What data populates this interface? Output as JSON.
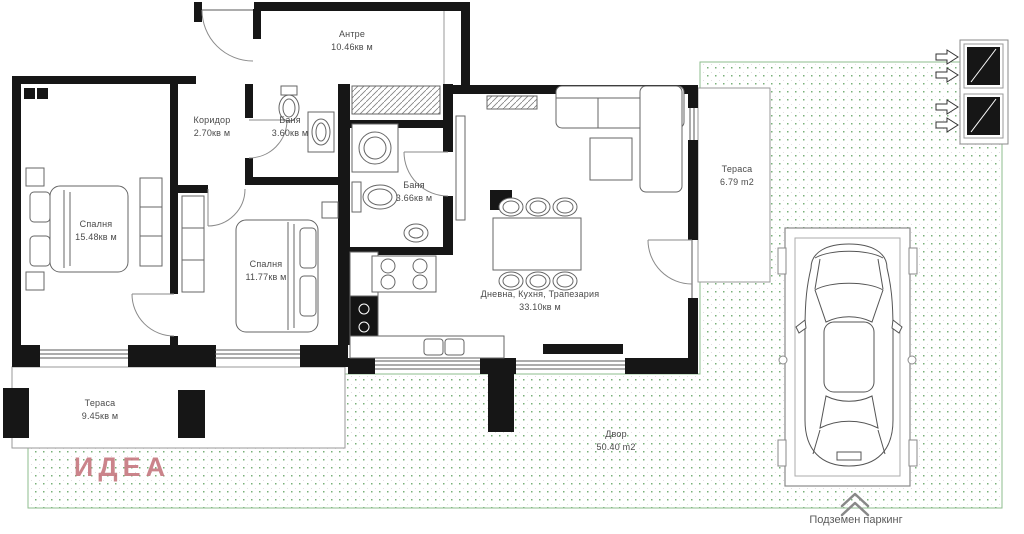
{
  "plan": {
    "logo": "ИДЕА",
    "rooms": [
      {
        "id": "entry",
        "name": "Антре",
        "area": "10.46кв м"
      },
      {
        "id": "bedroom-1",
        "name": "Спалня",
        "area": "15.48кв м"
      },
      {
        "id": "corridor",
        "name": "Коридор",
        "area": "2.70кв м"
      },
      {
        "id": "bathroom-1",
        "name": "Баня",
        "area": "3.60кв м"
      },
      {
        "id": "bathroom-2",
        "name": "Баня",
        "area": "3.66кв м"
      },
      {
        "id": "bedroom-2",
        "name": "Спалня",
        "area": "11.77кв м"
      },
      {
        "id": "living",
        "name": "Дневна, Кухня, Трапезария",
        "area": "33.10кв м"
      },
      {
        "id": "terrace-right",
        "name": "Тераса",
        "area": "6.79 m2"
      },
      {
        "id": "terrace-bottom",
        "name": "Тераса",
        "area": "9.45кв м"
      },
      {
        "id": "yard",
        "name": "Двор",
        "area": "50.40 m2"
      }
    ],
    "parking_label": "Подземен паркинг",
    "colors": {
      "wall": "#161616",
      "thin_line": "#5a5a5a",
      "green_dot": "#79b079",
      "green_border": "#8ebc8e",
      "logo": "#c4747c",
      "text": "#4a4a4a"
    }
  }
}
